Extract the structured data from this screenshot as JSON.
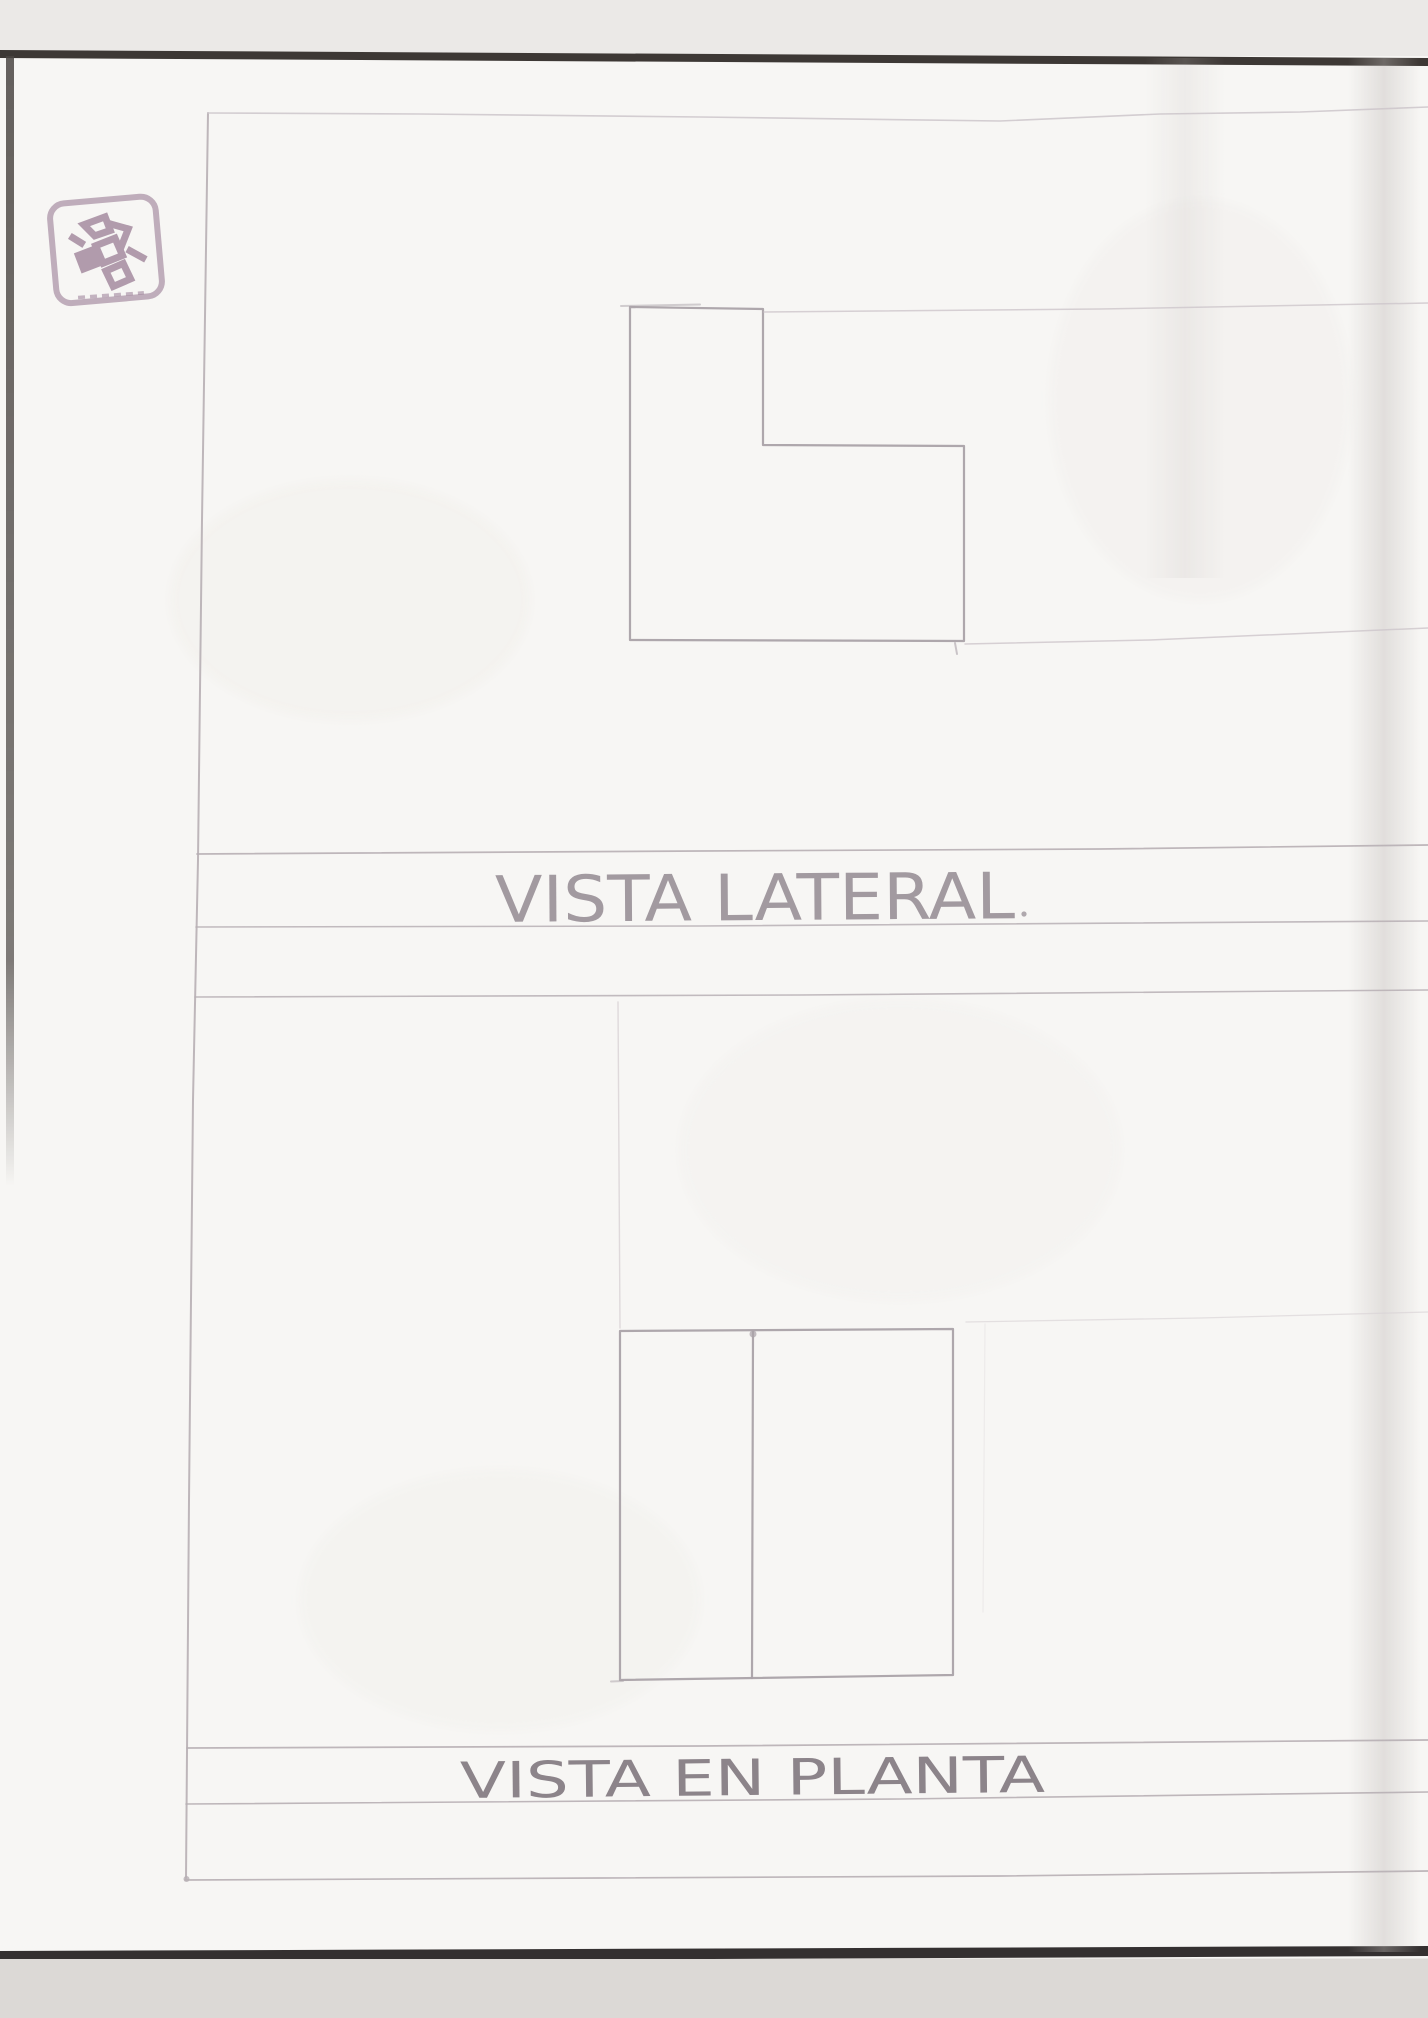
{
  "captions": {
    "side_view": "VISTA LATERAL",
    "plan_view": "VISTA EN PLANTA"
  },
  "colors": {
    "scanner_bg": "#eae8e5",
    "paper": "#f7f6f4",
    "paper_below": "#dcd9d6",
    "page_edge_dark": "#3d3835",
    "page_edge_left": "#4a4542",
    "pencil": "#aaa2a8",
    "pencil_line": "#b7afb4",
    "pencil_faint": "#cdc6ca",
    "construction": "#d8d2d5",
    "caption_side_color": "#a29aa0",
    "caption_plan_color": "#8c848a",
    "stamp_ink": "#9a7d95"
  },
  "side_view": {
    "caption": "VISTA LATERAL",
    "shape": "L-shaped step profile",
    "polygon": [
      [
        630,
        307
      ],
      [
        763,
        309
      ],
      [
        763,
        445
      ],
      [
        964,
        446
      ],
      [
        964,
        641
      ],
      [
        630,
        640
      ]
    ]
  },
  "plan_view": {
    "caption": "VISTA EN PLANTA",
    "rect": {
      "x": 620,
      "y": 1330,
      "w": 333,
      "h": 348
    },
    "divider_x": 753
  },
  "stamp": {
    "name": "ink-stamp",
    "color": "#9a7d95"
  }
}
